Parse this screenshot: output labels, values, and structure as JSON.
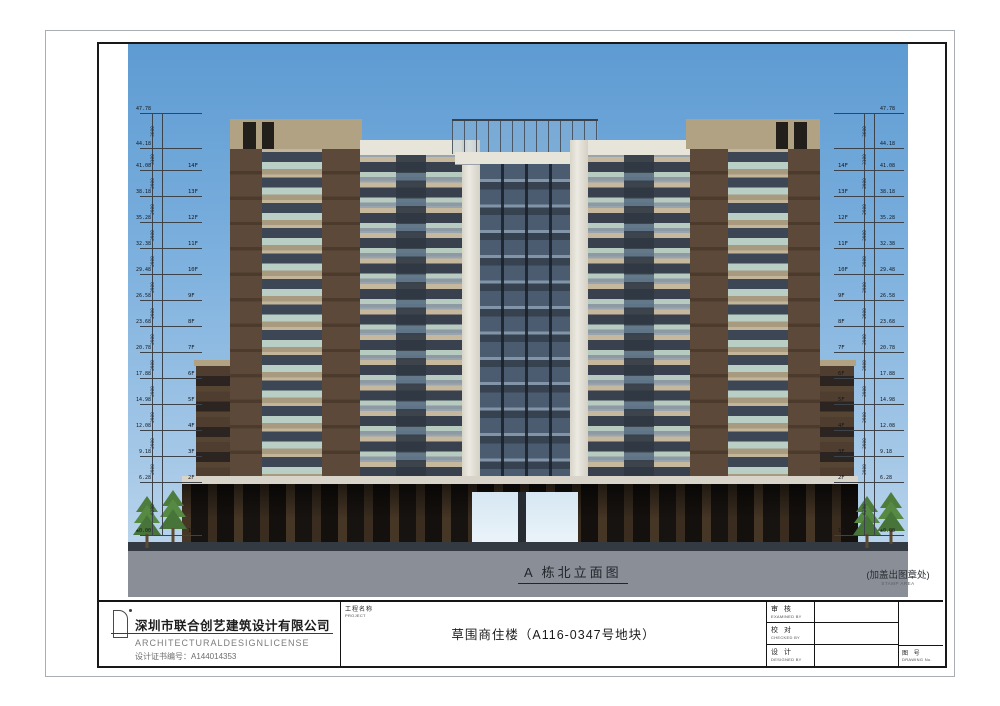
{
  "drawing": {
    "caption": "A 栋北立面图",
    "stamp_note": "(加盖出图章处)",
    "stamp_note_en": "STAMP AREA",
    "levels": [
      {
        "elev": "47.78",
        "floor": "",
        "dim": "3600",
        "y": 113
      },
      {
        "elev": "44.18",
        "floor": "",
        "dim": "3100",
        "y": 148
      },
      {
        "elev": "41.08",
        "floor": "14F",
        "dim": "2900",
        "y": 170
      },
      {
        "elev": "38.18",
        "floor": "13F",
        "dim": "2900",
        "y": 196
      },
      {
        "elev": "35.28",
        "floor": "12F",
        "dim": "2900",
        "y": 222
      },
      {
        "elev": "32.38",
        "floor": "11F",
        "dim": "2900",
        "y": 248
      },
      {
        "elev": "29.48",
        "floor": "10F",
        "dim": "2900",
        "y": 274
      },
      {
        "elev": "26.58",
        "floor": "9F",
        "dim": "2900",
        "y": 300
      },
      {
        "elev": "23.68",
        "floor": "8F",
        "dim": "2900",
        "y": 326
      },
      {
        "elev": "20.78",
        "floor": "7F",
        "dim": "2900",
        "y": 352
      },
      {
        "elev": "17.88",
        "floor": "6F",
        "dim": "2900",
        "y": 378
      },
      {
        "elev": "14.98",
        "floor": "5F",
        "dim": "2900",
        "y": 404
      },
      {
        "elev": "12.08",
        "floor": "4F",
        "dim": "2900",
        "y": 430
      },
      {
        "elev": "9.18",
        "floor": "3F",
        "dim": "2900",
        "y": 456
      },
      {
        "elev": "6.28",
        "floor": "2F",
        "dim": "6280",
        "y": 482
      },
      {
        "elev": "±0.00",
        "floor": "1F",
        "dim": "",
        "y": 535
      }
    ]
  },
  "title_block": {
    "company": {
      "name": "深圳市联合创艺建筑设计有限公司",
      "license": "ARCHITECTURALDESIGNLICENSE",
      "cert": "设计证书编号：A144014353"
    },
    "project_label": "工程名称",
    "project_label_en": "PROJECT",
    "project_name": "草围商住楼（A116-0347号地块）",
    "roles": [
      {
        "cn": "审 核",
        "en": "EXAMINED BY"
      },
      {
        "cn": "校 对",
        "en": "CHECKED BY"
      },
      {
        "cn": "设 计",
        "en": "DESIGNED BY"
      }
    ],
    "drawing_no_label": "图 号",
    "drawing_no_label_en": "DRAWING No."
  },
  "colors": {
    "sky_top": "#5e9bd2",
    "sky_bottom": "#c4daee",
    "wall_tan": "#c6b89c",
    "brick_brown": "#5d4939",
    "window_glass": "#39414e",
    "railing_glass": "#b7cbc1",
    "ground_gray": "#8a8f97",
    "frame_black": "#191919"
  }
}
